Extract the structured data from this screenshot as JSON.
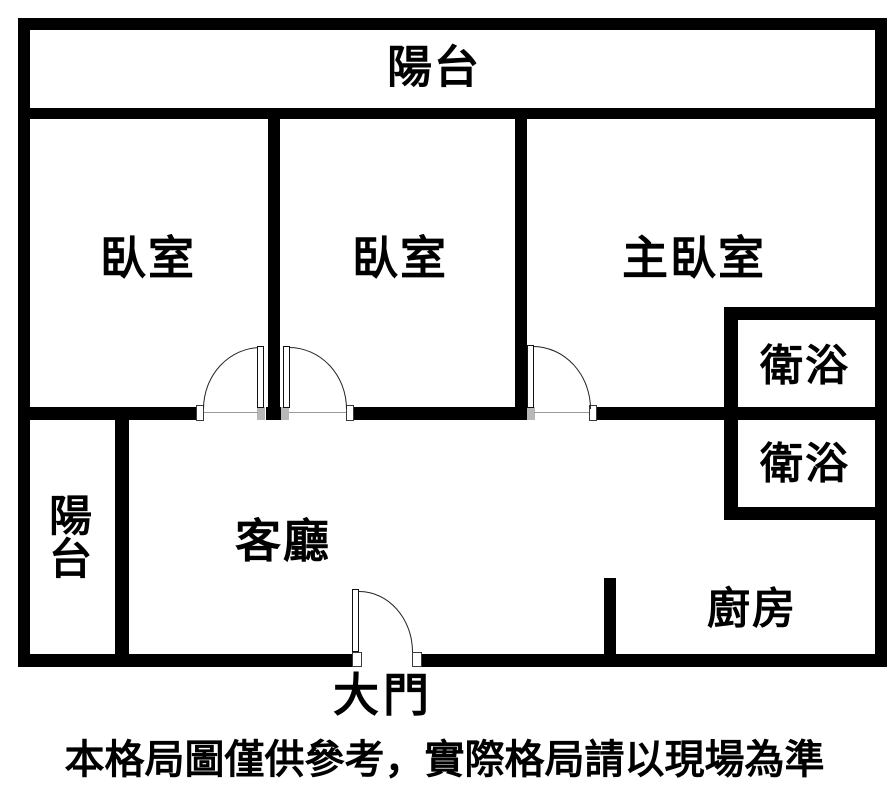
{
  "page": {
    "background_color": "#ffffff",
    "wall_color": "#000000",
    "text_color": "#000000"
  },
  "floorplan": {
    "rooms": {
      "balcony_top": {
        "label": "陽台"
      },
      "bedroom_1": {
        "label": "臥室"
      },
      "bedroom_2": {
        "label": "臥室"
      },
      "master_bedroom": {
        "label": "主臥室"
      },
      "bathroom_upper": {
        "label": "衛浴"
      },
      "bathroom_lower": {
        "label": "衛浴"
      },
      "balcony_left": {
        "label": "陽台"
      },
      "living_room": {
        "label": "客廳"
      },
      "kitchen": {
        "label": "廚房"
      }
    },
    "entrance": {
      "label": "大門"
    },
    "doors": [
      {
        "name": "bedroom-1-door",
        "swing": "hinge-right"
      },
      {
        "name": "bedroom-2-door",
        "swing": "hinge-left"
      },
      {
        "name": "master-bedroom-door",
        "swing": "hinge-left"
      },
      {
        "name": "entrance-door",
        "swing": "hinge-left"
      }
    ],
    "disclaimer": "本格局圖僅供參考，實際格局請以現場為準"
  }
}
